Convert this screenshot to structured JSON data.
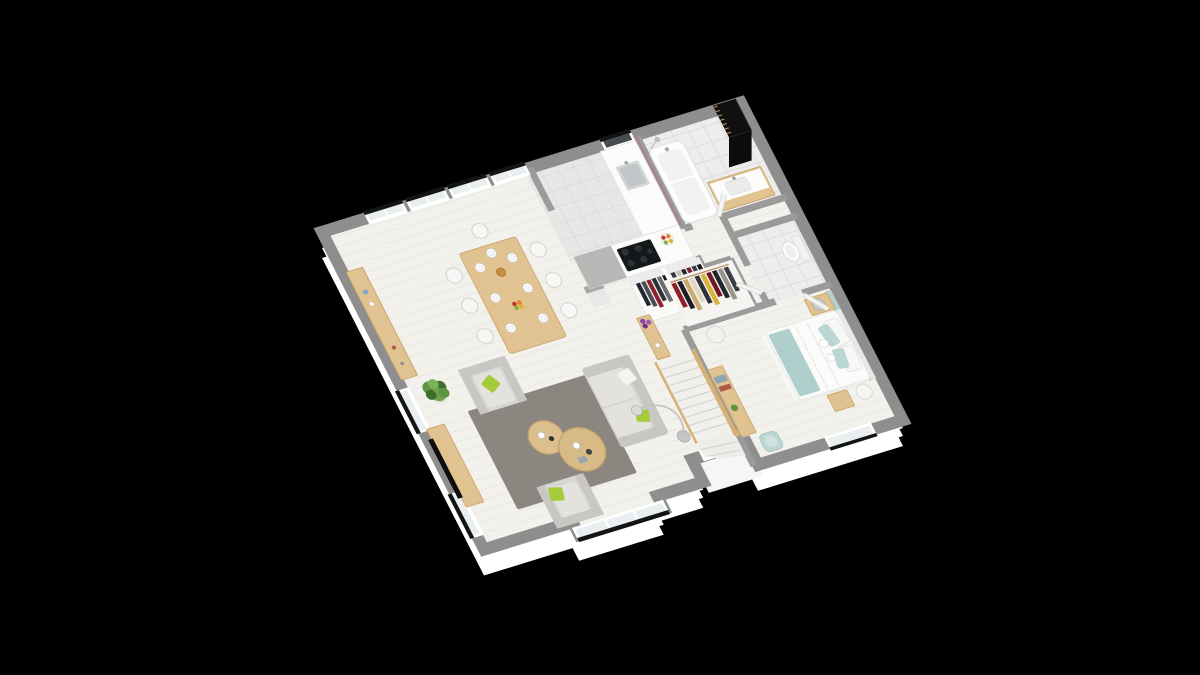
{
  "scene": {
    "description": "isometric-3d-floor-plan-render",
    "rooms": [
      {
        "name": "dining-area",
        "floor": "light-wood"
      },
      {
        "name": "living-room",
        "floor": "light-wood"
      },
      {
        "name": "kitchen",
        "floor": "gray-tile"
      },
      {
        "name": "bathroom",
        "floor": "white-tile"
      },
      {
        "name": "wc",
        "floor": "white-tile"
      },
      {
        "name": "hallway",
        "floor": "light-wood"
      },
      {
        "name": "bedroom",
        "floor": "light-wood"
      },
      {
        "name": "staircase",
        "floor": "wood-steps"
      },
      {
        "name": "entry-porch",
        "floor": "white-slab"
      }
    ],
    "furniture": [
      "dining-table",
      "dining-chairs",
      "sideboard",
      "potted-plant",
      "tv-bench",
      "tv-screen",
      "area-rug",
      "coffee-tables",
      "sofa",
      "armchair",
      "armchair-2",
      "arc-floor-lamp",
      "kitchen-counter",
      "kitchen-sink",
      "cooktop",
      "fruit-bowl",
      "entry-coat-closet",
      "bathtub",
      "bathroom-vanity",
      "black-storage-column",
      "toilet",
      "dressing-closet",
      "hall-console",
      "hall-pouf-lamp",
      "stairs",
      "bed",
      "nightstand",
      "table-lamp",
      "drum-lamp",
      "bedroom-desk",
      "teal-chair",
      "pedestal"
    ]
  },
  "palette": {
    "background": "#000000",
    "outer_wall": "#ffffff",
    "wall": "#8e8e8e",
    "wall_inner": "#9b9b9b",
    "floor": "#f2f1ec",
    "plank": "#e9e7e2",
    "tile_kitchen": "#e7e7e6",
    "tile_bath": "#ededec",
    "tile_line": "#dbdbda",
    "glass": "#e9eef0",
    "glass_dark": "#474c4f",
    "lintel": "#141414",
    "wood": "#e0c391",
    "wood_dark": "#c9a469",
    "stair_wood": "#d6b176",
    "rug": "#8b8680",
    "sofa": "#d6d5d2",
    "sofa_shade": "#c8c7c4",
    "seat": "#e3e2df",
    "green": "#a5cb3a",
    "teal_wall": "#b5d1ce",
    "teal_throw": "#aecfcc",
    "teal_chair": "#bcd6d3",
    "mauve": "#a9858e",
    "metal": "#c6c9ca",
    "plant": "#5d9440",
    "plant_dark": "#3e6e2c",
    "column_black": "#101010",
    "counter": "#fbfbfa",
    "cooktop": "#15181a",
    "white": "#ffffff"
  },
  "clothes": {
    "entry_closet": [
      "#23262c",
      "#4a4e55",
      "#8e2230",
      "#2e3138",
      "#6b6e75",
      "#1a1c21",
      "#33363d",
      "#c9c2b2",
      "#23262c",
      "#7b2230",
      "#3a3d44",
      "#191b20"
    ],
    "dressing": [
      "#8d1f2c",
      "#1c1e24",
      "#c9a96d",
      "#e0d6c2",
      "#2e3138",
      "#d9b13f",
      "#741722",
      "#23262c",
      "#9a948a",
      "#3a3d45"
    ]
  },
  "fruits": [
    "#c0392b",
    "#e67e22",
    "#7fb23b",
    "#e1b12c"
  ],
  "flowers": [
    "#8e44ad",
    "#9b59b6",
    "#6c3483"
  ]
}
